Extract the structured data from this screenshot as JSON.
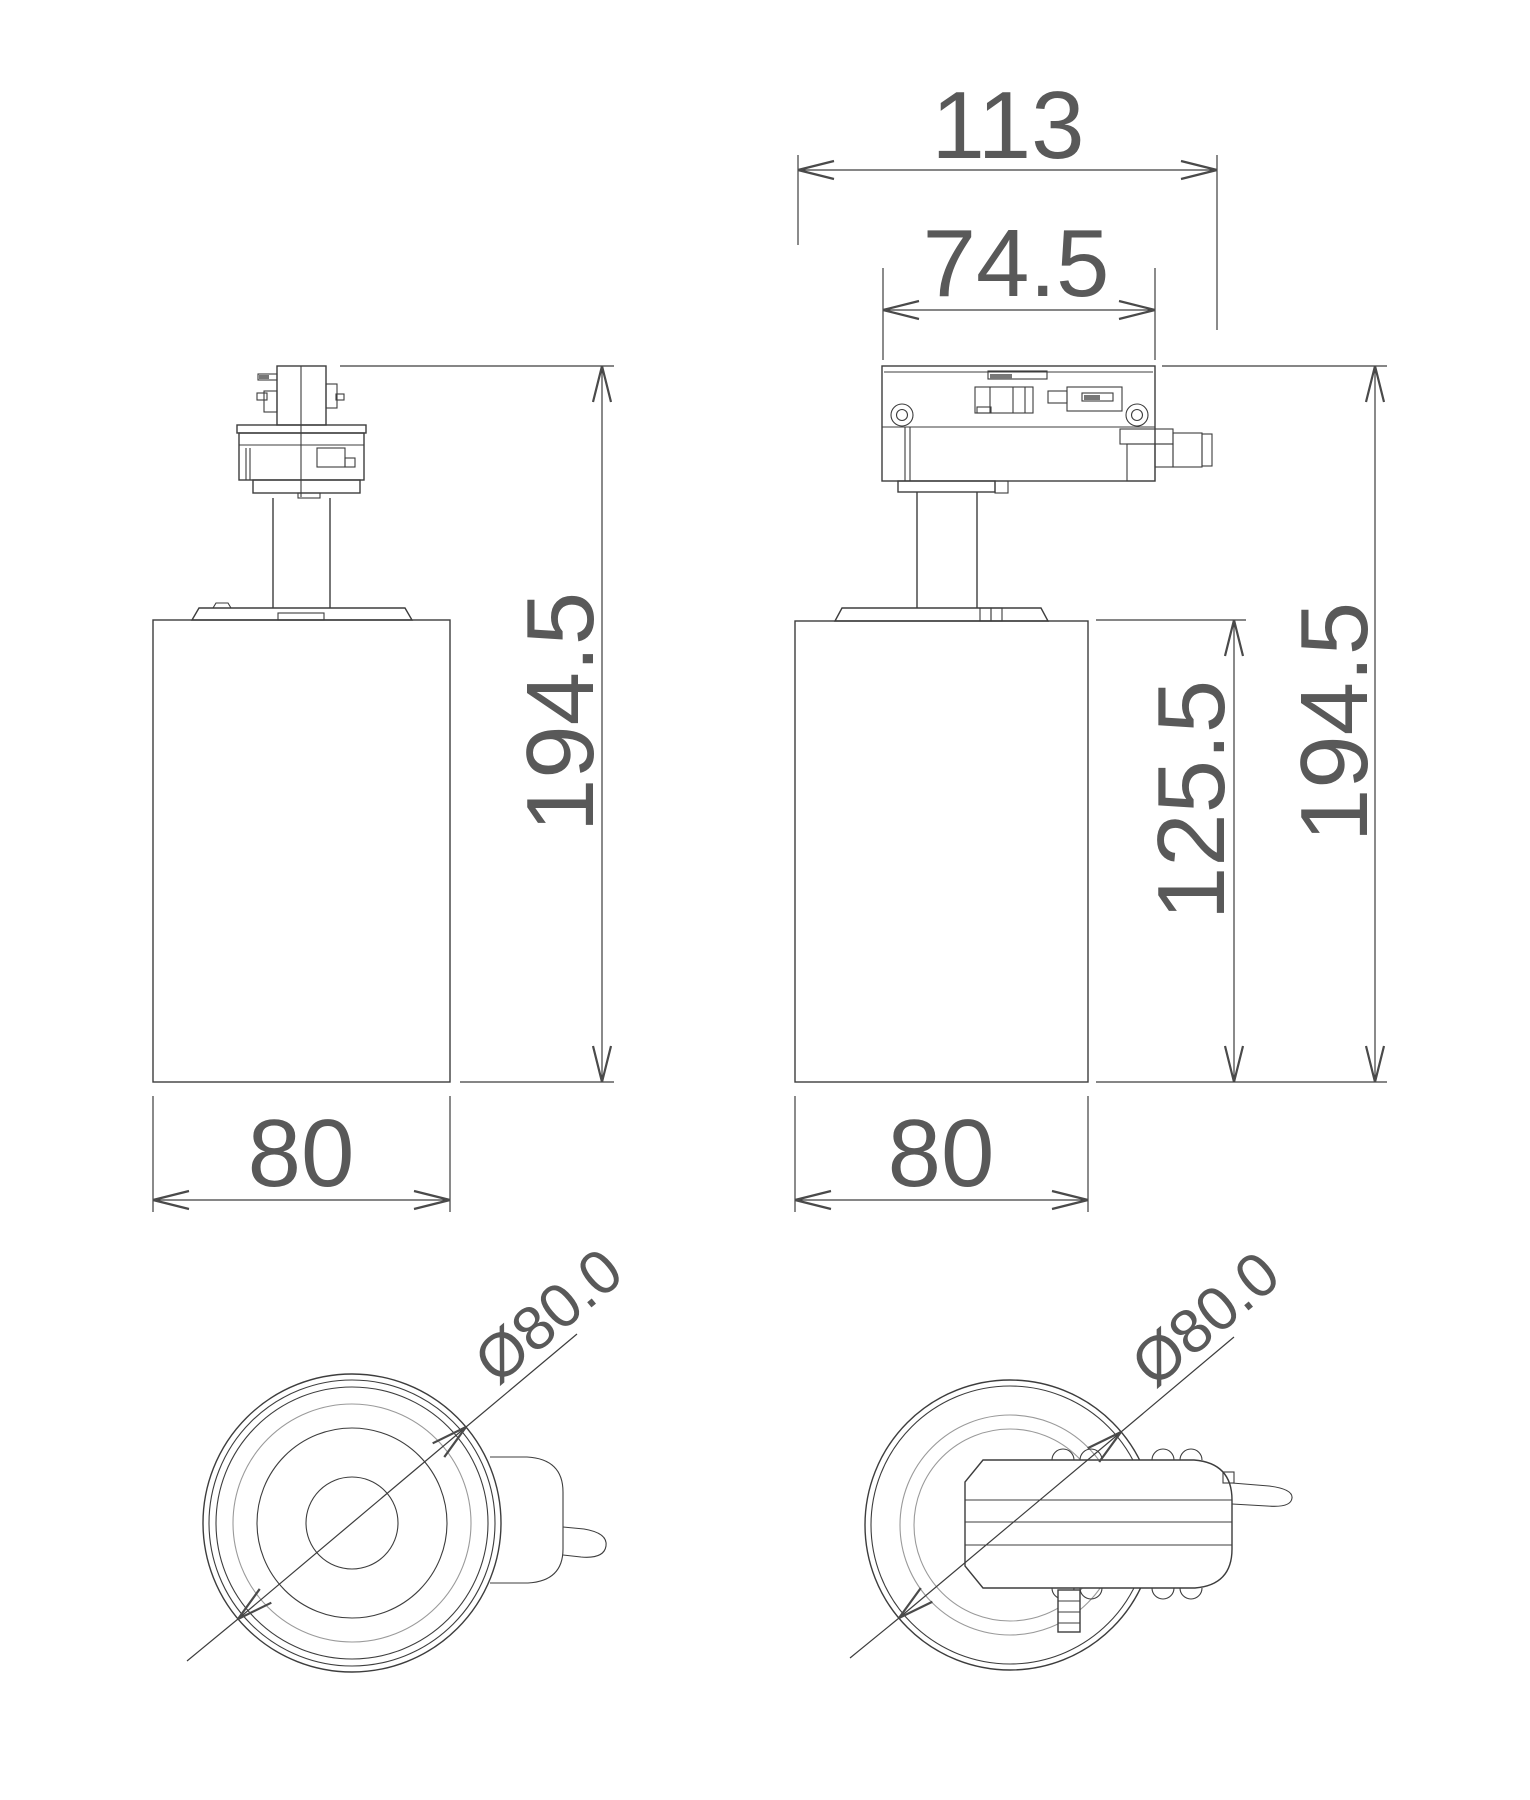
{
  "drawing": {
    "colors": {
      "line": "#3d3d3d",
      "line_light": "#9a9a9a",
      "dim_text": "#595959"
    },
    "views": {
      "side": {
        "overall_height": "194.5",
        "body_width": "80"
      },
      "front": {
        "overall_width": "113",
        "adapter_width": "74.5",
        "overall_height": "194.5",
        "body_height": "125.5",
        "body_width": "80"
      },
      "bottom_lens": {
        "diameter": "Ø80.0"
      },
      "top_adapter": {
        "diameter": "Ø80.0"
      }
    }
  }
}
